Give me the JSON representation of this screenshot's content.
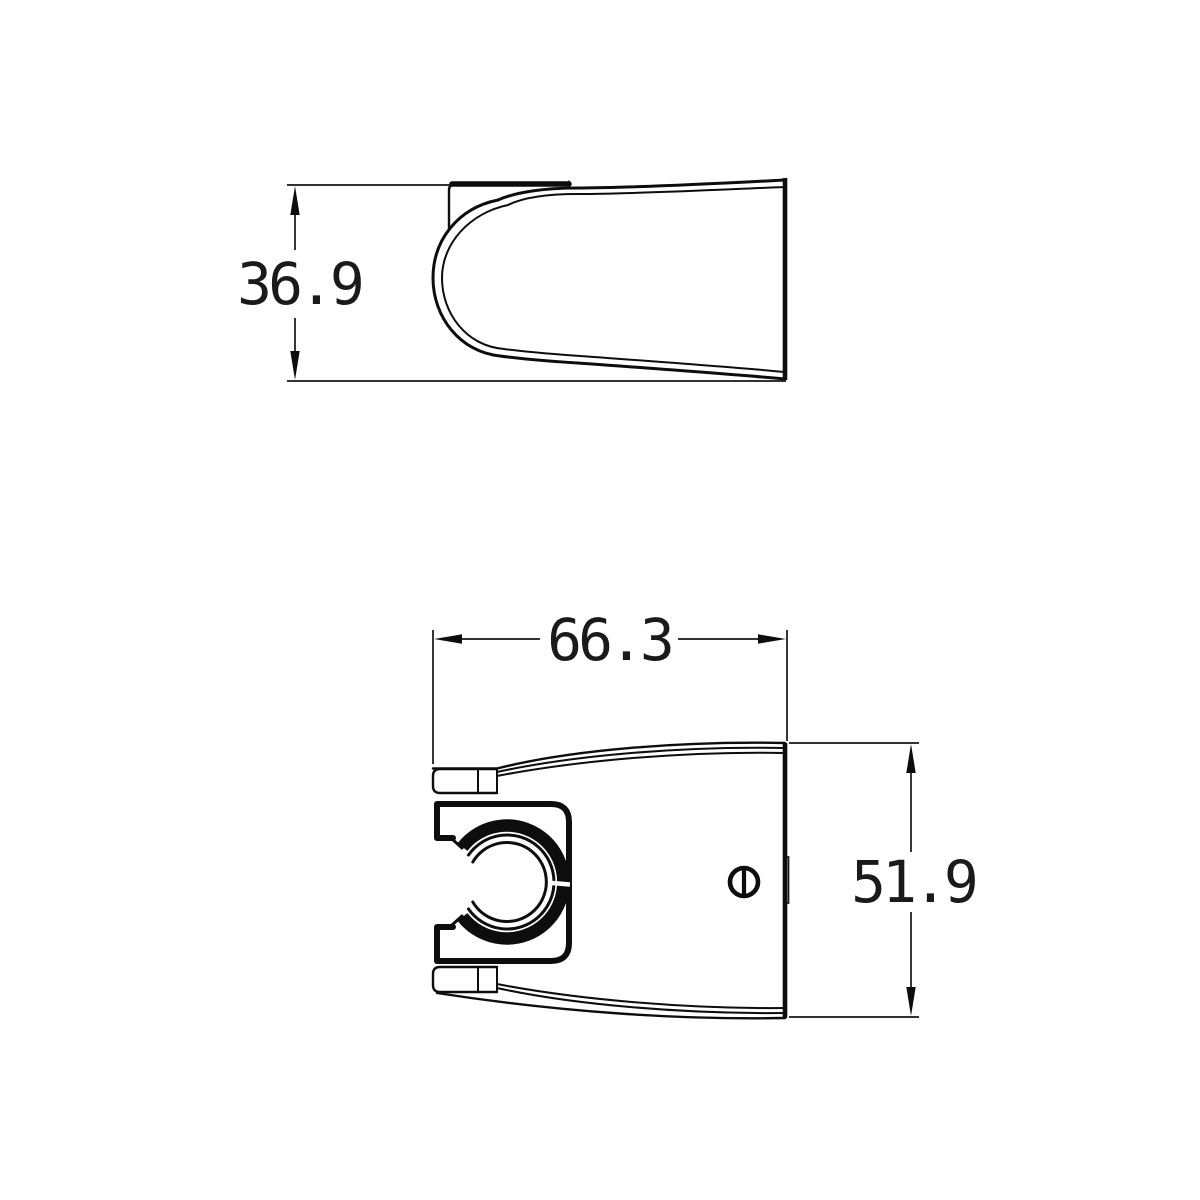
{
  "drawing": {
    "background_color": "#ffffff",
    "line_color": "#0d0d0d",
    "views": {
      "side": {
        "label": "side profile view of shower holder"
      },
      "front": {
        "label": "front view of shower holder"
      }
    },
    "dimensions": {
      "depth": {
        "value": "36.9"
      },
      "width": {
        "value": "66.3"
      },
      "height": {
        "value": "51.9"
      }
    }
  }
}
